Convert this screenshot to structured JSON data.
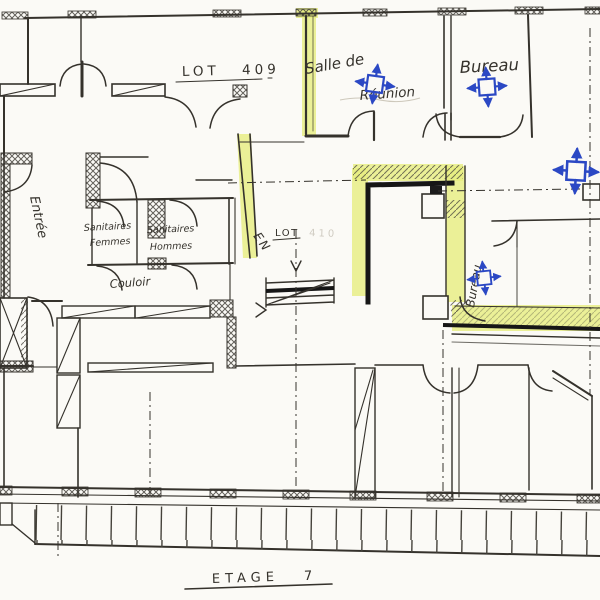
{
  "document": {
    "kind": "scanned hand-drawn architectural floor plan",
    "floor_label": "ETAGE  7"
  },
  "colors": {
    "paper": "#fbfaf6",
    "ink": "#35322c",
    "wall_dark": "#161616",
    "highlight_yellow": "#e7ee7f",
    "annotation_blue": "#2b48c4",
    "faint_ink": "#a49d8e"
  },
  "labels": {
    "lot409": "LOT  409",
    "salle_line1": "Salle de",
    "salle_line2": "Réunion",
    "bureau_top": "Bureau",
    "bureau_right": "Bureau",
    "entree": "Entrée",
    "sanitaires_f1": "Sanitaires",
    "sanitaires_f2": "Femmes",
    "sanitaires_h1": "Sanitaires",
    "sanitaires_h2": "Hommes",
    "couloir": "Couloir",
    "lot_mid": "LOT",
    "lot_mid_faint": "410",
    "stair_direction": "EN",
    "etage": "ETAGE  7"
  },
  "icons": {
    "air_diffuser": "blue square with four outward arrows (hand-drawn ventilation/diffuser mark, 4 instances)"
  }
}
